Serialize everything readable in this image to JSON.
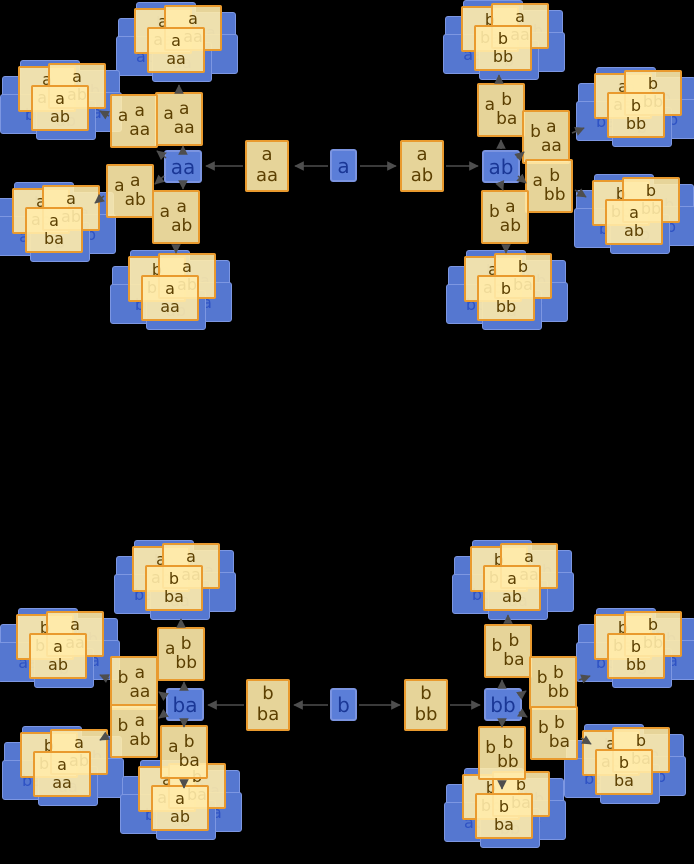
{
  "colors": {
    "background": "#000000",
    "node_fill": "#5b7ed8",
    "node_border": "#7b94e0",
    "node_text": "#1a3796",
    "card_fill": "rgba(255,235,170,0.9)",
    "card_border": "#e99a2e",
    "card_text": "#5c4002",
    "frame_fill": "#5577d0",
    "frame_border": "#7d97e2",
    "frame_text": "#2e52c4",
    "arrow": "#4e4e4e"
  },
  "nodes": [
    {
      "label": "a",
      "x": 330,
      "y": 149
    },
    {
      "label": "aa",
      "x": 164,
      "y": 150
    },
    {
      "label": "ab",
      "x": 482,
      "y": 150
    },
    {
      "label": "b",
      "x": 330,
      "y": 688
    },
    {
      "label": "ba",
      "x": 166,
      "y": 688
    },
    {
      "label": "bb",
      "x": 484,
      "y": 688
    }
  ],
  "bridge_cards": [
    {
      "t": "a",
      "b": "aa",
      "x": 245,
      "y": 140
    },
    {
      "t": "a",
      "b": "ab",
      "x": 400,
      "y": 140
    },
    {
      "t": "b",
      "b": "ba",
      "x": 246,
      "y": 679
    },
    {
      "t": "b",
      "b": "bb",
      "x": 404,
      "y": 679
    }
  ],
  "inner_cards": [
    {
      "t": "a",
      "b": "aa",
      "extra": "a",
      "side": "right",
      "x": 155,
      "y": 92
    },
    {
      "t": "a",
      "b": "aa",
      "extra": "a",
      "side": "left",
      "x": 110,
      "y": 94
    },
    {
      "t": "a",
      "b": "ab",
      "extra": "a",
      "side": "right",
      "x": 106,
      "y": 164
    },
    {
      "t": "a",
      "b": "ab",
      "extra": "a",
      "side": "left",
      "x": 152,
      "y": 190
    },
    {
      "t": "b",
      "b": "ba",
      "extra": "a",
      "side": "left",
      "x": 477,
      "y": 83
    },
    {
      "t": "a",
      "b": "aa",
      "extra": "b",
      "side": "right",
      "x": 522,
      "y": 110
    },
    {
      "t": "b",
      "b": "bb",
      "extra": "a",
      "side": "left",
      "x": 525,
      "y": 159
    },
    {
      "t": "a",
      "b": "ab",
      "extra": "b",
      "side": "right",
      "x": 481,
      "y": 190
    },
    {
      "t": "b",
      "b": "bb",
      "extra": "a",
      "side": "right",
      "x": 157,
      "y": 627
    },
    {
      "t": "a",
      "b": "aa",
      "extra": "b",
      "side": "left",
      "x": 110,
      "y": 656
    },
    {
      "t": "a",
      "b": "ab",
      "extra": "b",
      "side": "left",
      "x": 110,
      "y": 704
    },
    {
      "t": "b",
      "b": "ba",
      "extra": "a",
      "side": "right",
      "x": 160,
      "y": 725
    },
    {
      "t": "b",
      "b": "ba",
      "extra": "b",
      "side": "left",
      "x": 484,
      "y": 624
    },
    {
      "t": "b",
      "b": "bb",
      "extra": "b",
      "side": "right",
      "x": 529,
      "y": 656
    },
    {
      "t": "b",
      "b": "ba",
      "extra": "b",
      "side": "right",
      "x": 530,
      "y": 706
    },
    {
      "t": "b",
      "b": "bb",
      "extra": "b",
      "side": "left",
      "x": 478,
      "y": 726
    }
  ],
  "stacks": [
    {
      "x": 178,
      "y": 42,
      "cards": [
        {
          "t": "a",
          "b": "aa"
        },
        {
          "t": "a",
          "b": "aa"
        },
        {
          "t": "a",
          "b": "aa"
        }
      ],
      "frames": [
        "a",
        "aa",
        "ba",
        "a",
        "ab",
        "aa"
      ]
    },
    {
      "x": 62,
      "y": 100,
      "cards": [
        {
          "t": "a",
          "b": "aa"
        },
        {
          "t": "a",
          "b": "ab"
        },
        {
          "t": "a",
          "b": "ab"
        }
      ],
      "frames": [
        "a",
        "ab",
        "a",
        "aa",
        "b",
        "ab"
      ]
    },
    {
      "x": 56,
      "y": 222,
      "cards": [
        {
          "t": "a",
          "b": "ab"
        },
        {
          "t": "a",
          "b": "ab"
        },
        {
          "t": "a",
          "b": "ba"
        }
      ],
      "frames": [
        "ab",
        "a",
        "ba",
        "ab",
        "a",
        "b"
      ]
    },
    {
      "x": 172,
      "y": 290,
      "cards": [
        {
          "t": "b",
          "b": "bb"
        },
        {
          "t": "a",
          "b": "ab"
        },
        {
          "t": "a",
          "b": "aa"
        }
      ],
      "frames": [
        "a",
        "aa",
        "ab",
        "ba",
        "b",
        "ab"
      ]
    },
    {
      "x": 505,
      "y": 40,
      "cards": [
        {
          "t": "b",
          "b": "ba"
        },
        {
          "t": "a",
          "b": "aa"
        },
        {
          "t": "b",
          "b": "bb"
        }
      ],
      "frames": [
        "a",
        "ab",
        "ba",
        "a",
        "aa",
        "b"
      ]
    },
    {
      "x": 638,
      "y": 107,
      "cards": [
        {
          "t": "a",
          "b": "aa"
        },
        {
          "t": "b",
          "b": "bb"
        },
        {
          "t": "b",
          "b": "bb"
        }
      ],
      "frames": [
        "a",
        "b",
        "aa",
        "bb",
        "ba",
        "b"
      ]
    },
    {
      "x": 636,
      "y": 214,
      "cards": [
        {
          "t": "b",
          "b": "bb"
        },
        {
          "t": "b",
          "b": "bb"
        },
        {
          "t": "a",
          "b": "ab"
        }
      ],
      "frames": [
        "b",
        "bb",
        "ba",
        "ab",
        "b",
        "bb"
      ]
    },
    {
      "x": 508,
      "y": 290,
      "cards": [
        {
          "t": "a",
          "b": "ab"
        },
        {
          "t": "b",
          "b": "ba"
        },
        {
          "t": "b",
          "b": "bb"
        }
      ],
      "frames": [
        "ab",
        "bb",
        "ba",
        "b",
        "bb",
        "a"
      ]
    },
    {
      "x": 176,
      "y": 580,
      "cards": [
        {
          "t": "a",
          "b": "ab"
        },
        {
          "t": "a",
          "b": "aa"
        },
        {
          "t": "b",
          "b": "ba"
        }
      ],
      "frames": [
        "b",
        "ba",
        "bb",
        "a",
        "ba",
        "aa"
      ]
    },
    {
      "x": 60,
      "y": 648,
      "cards": [
        {
          "t": "b",
          "b": "ba"
        },
        {
          "t": "a",
          "b": "aa"
        },
        {
          "t": "a",
          "b": "ab"
        }
      ],
      "frames": [
        "b",
        "ab",
        "a",
        "ba",
        "aa",
        "b"
      ]
    },
    {
      "x": 64,
      "y": 766,
      "cards": [
        {
          "t": "b",
          "b": "ba"
        },
        {
          "t": "a",
          "b": "ab"
        },
        {
          "t": "a",
          "b": "aa"
        }
      ],
      "frames": [
        "ba",
        "ab",
        "b",
        "a",
        "ba",
        "aa"
      ]
    },
    {
      "x": 182,
      "y": 800,
      "cards": [
        {
          "t": "a",
          "b": "aa"
        },
        {
          "t": "b",
          "b": "ba"
        },
        {
          "t": "a",
          "b": "ab"
        }
      ],
      "frames": [
        "b",
        "ba",
        "ab",
        "aa",
        "b",
        "a"
      ]
    },
    {
      "x": 514,
      "y": 580,
      "cards": [
        {
          "t": "b",
          "b": "bb"
        },
        {
          "t": "a",
          "b": "aa"
        },
        {
          "t": "a",
          "b": "ab"
        }
      ],
      "frames": [
        "b",
        "bb",
        "ba",
        "a",
        "bb",
        "aa"
      ]
    },
    {
      "x": 638,
      "y": 648,
      "cards": [
        {
          "t": "b",
          "b": "ba"
        },
        {
          "t": "b",
          "b": "bb"
        },
        {
          "t": "b",
          "b": "bb"
        }
      ],
      "frames": [
        "b",
        "bb",
        "b",
        "ba",
        "bb",
        "b"
      ]
    },
    {
      "x": 626,
      "y": 764,
      "cards": [
        {
          "t": "a",
          "b": "ab"
        },
        {
          "t": "b",
          "b": "ba"
        },
        {
          "t": "b",
          "b": "ba"
        }
      ],
      "frames": [
        "ba",
        "b",
        "bb",
        "ab",
        "ba",
        "b"
      ]
    },
    {
      "x": 506,
      "y": 808,
      "cards": [
        {
          "t": "b",
          "b": "bb"
        },
        {
          "t": "b",
          "b": "ba"
        },
        {
          "t": "b",
          "b": "ba"
        }
      ],
      "frames": [
        "b",
        "bb",
        "ba",
        "b",
        "ab",
        "bb"
      ]
    }
  ],
  "arrows": [
    [
      328,
      166,
      295,
      166
    ],
    [
      243,
      166,
      206,
      166
    ],
    [
      360,
      166,
      396,
      166
    ],
    [
      446,
      166,
      478,
      166
    ],
    [
      328,
      705,
      294,
      705
    ],
    [
      244,
      705,
      208,
      705
    ],
    [
      359,
      705,
      400,
      705
    ],
    [
      450,
      705,
      480,
      705
    ],
    [
      183,
      152,
      183,
      146
    ],
    [
      166,
      158,
      157,
      151
    ],
    [
      164,
      176,
      155,
      184
    ],
    [
      183,
      185,
      183,
      189
    ],
    [
      179,
      91,
      179,
      85
    ],
    [
      109,
      116,
      100,
      111
    ],
    [
      104,
      196,
      95,
      203
    ],
    [
      176,
      246,
      176,
      253
    ],
    [
      501,
      149,
      501,
      140
    ],
    [
      517,
      158,
      524,
      152
    ],
    [
      518,
      176,
      526,
      183
    ],
    [
      501,
      185,
      503,
      190
    ],
    [
      499,
      82,
      499,
      75
    ],
    [
      572,
      133,
      584,
      128
    ],
    [
      575,
      190,
      586,
      197
    ],
    [
      506,
      246,
      506,
      253
    ],
    [
      184,
      687,
      184,
      682
    ],
    [
      166,
      697,
      159,
      692
    ],
    [
      166,
      713,
      159,
      718
    ],
    [
      184,
      723,
      184,
      727
    ],
    [
      181,
      626,
      181,
      619
    ],
    [
      109,
      679,
      100,
      675
    ],
    [
      109,
      735,
      100,
      740
    ],
    [
      184,
      781,
      184,
      788
    ],
    [
      502,
      687,
      502,
      680
    ],
    [
      519,
      696,
      526,
      691
    ],
    [
      519,
      712,
      527,
      717
    ],
    [
      502,
      723,
      502,
      727
    ],
    [
      508,
      622,
      508,
      615
    ],
    [
      579,
      680,
      590,
      676
    ],
    [
      581,
      738,
      591,
      744
    ],
    [
      502,
      782,
      502,
      789
    ]
  ]
}
